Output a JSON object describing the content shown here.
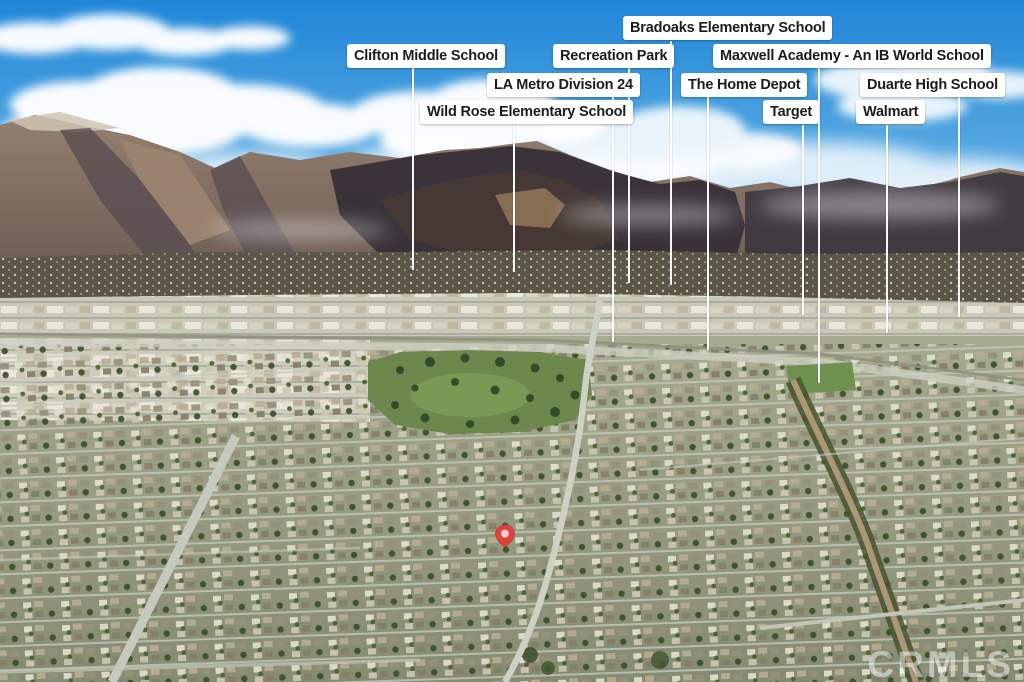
{
  "scene_title": "Aerial neighborhood photo with location callouts",
  "callouts": [
    {
      "label": "Bradoaks Elementary School",
      "pill_x": 623,
      "pill_y": 16,
      "line_x": 670,
      "line_y1": 41,
      "line_y2": 285
    },
    {
      "label": "Clifton Middle School",
      "pill_x": 347,
      "pill_y": 44,
      "line_x": 412,
      "line_y1": 67,
      "line_y2": 270
    },
    {
      "label": "Recreation Park",
      "pill_x": 553,
      "pill_y": 44,
      "line_x": 628,
      "line_y1": 67,
      "line_y2": 283
    },
    {
      "label": "Maxwell Academy - An IB World School",
      "pill_x": 713,
      "pill_y": 44,
      "line_x": 818,
      "line_y1": 67,
      "line_y2": 383
    },
    {
      "label": "LA Metro Division 24",
      "pill_x": 487,
      "pill_y": 73,
      "line_x": 612,
      "line_y1": 97,
      "line_y2": 342
    },
    {
      "label": "The Home Depot",
      "pill_x": 681,
      "pill_y": 73,
      "line_x": 707,
      "line_y1": 97,
      "line_y2": 350
    },
    {
      "label": "Duarte High School",
      "pill_x": 860,
      "pill_y": 73,
      "line_x": 958,
      "line_y1": 97,
      "line_y2": 317
    },
    {
      "label": "Wild Rose Elementary School",
      "pill_x": 420,
      "pill_y": 100,
      "line_x": 513,
      "line_y1": 124,
      "line_y2": 272
    },
    {
      "label": "Target",
      "pill_x": 763,
      "pill_y": 100,
      "line_x": 802,
      "line_y1": 125,
      "line_y2": 315
    },
    {
      "label": "Walmart",
      "pill_x": 856,
      "pill_y": 100,
      "line_x": 886,
      "line_y1": 125,
      "line_y2": 333
    }
  ],
  "pin": {
    "x": 505,
    "y": 534
  },
  "watermark": {
    "text": "CRMLS"
  },
  "colors": {
    "label_bg": "#ffffff",
    "label_text": "#1c1c1c",
    "callout_line": "#ffffff",
    "pin_red": "#e2403a",
    "pin_inner": "#f3d2cd",
    "watermark_text": "#ffffff",
    "sky_top": "#1f86d8",
    "sky_horizon": "#bcdcee",
    "mountain_lit": "#93806f",
    "mountain_shadow": "#372f37",
    "park_green": "#6e874d"
  }
}
